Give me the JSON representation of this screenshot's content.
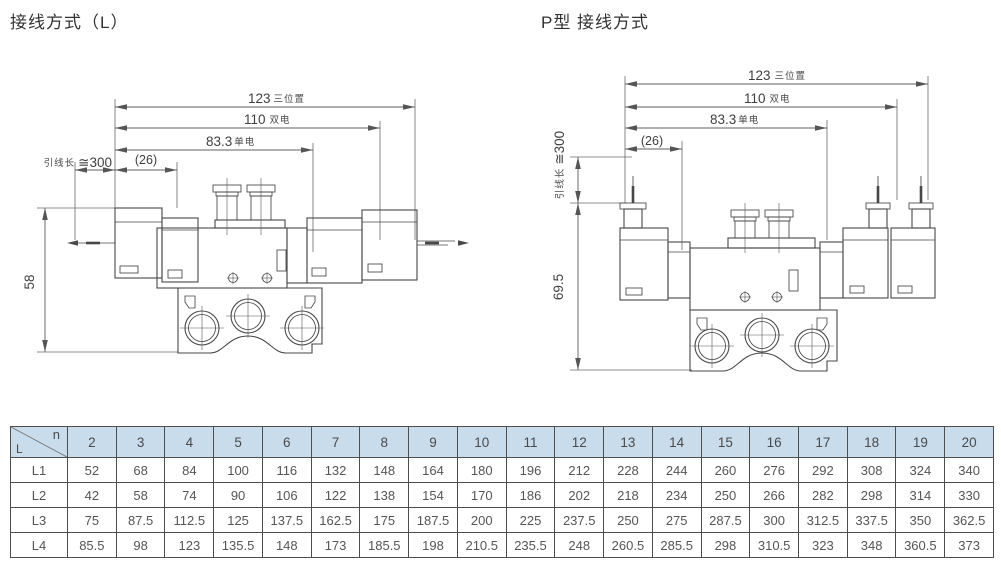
{
  "titles": {
    "left": "接线方式（L）",
    "right": "P型 接线方式"
  },
  "left_drawing": {
    "dim_123": "123",
    "dim_123_suffix": "三位置",
    "dim_110": "110",
    "dim_110_suffix": "双电",
    "dim_83": "83.3",
    "dim_83_suffix": "单电",
    "lead_label": "引线长",
    "lead_value": "≅300",
    "dim_26": "(26)",
    "dim_height": "58"
  },
  "right_drawing": {
    "dim_123": "123",
    "dim_123_suffix": "三位置",
    "dim_110": "110",
    "dim_110_suffix": "双电",
    "dim_83": "83.3",
    "dim_83_suffix": "单电",
    "lead_label": "引线长",
    "lead_value": "≅300",
    "dim_26": "(26)",
    "dim_height": "69.5"
  },
  "table": {
    "corner_top": "n",
    "corner_bottom": "L",
    "columns": [
      "2",
      "3",
      "4",
      "5",
      "6",
      "7",
      "8",
      "9",
      "10",
      "11",
      "12",
      "13",
      "14",
      "15",
      "16",
      "17",
      "18",
      "19",
      "20"
    ],
    "rows": [
      {
        "label": "L1",
        "values": [
          "52",
          "68",
          "84",
          "100",
          "116",
          "132",
          "148",
          "164",
          "180",
          "196",
          "212",
          "228",
          "244",
          "260",
          "276",
          "292",
          "308",
          "324",
          "340"
        ]
      },
      {
        "label": "L2",
        "values": [
          "42",
          "58",
          "74",
          "90",
          "106",
          "122",
          "138",
          "154",
          "170",
          "186",
          "202",
          "218",
          "234",
          "250",
          "266",
          "282",
          "298",
          "314",
          "330"
        ]
      },
      {
        "label": "L3",
        "values": [
          "75",
          "87.5",
          "112.5",
          "125",
          "137.5",
          "162.5",
          "175",
          "187.5",
          "200",
          "225",
          "237.5",
          "250",
          "275",
          "287.5",
          "300",
          "312.5",
          "337.5",
          "350",
          "362.5"
        ]
      },
      {
        "label": "L4",
        "values": [
          "85.5",
          "98",
          "123",
          "135.5",
          "148",
          "173",
          "185.5",
          "198",
          "210.5",
          "235.5",
          "248",
          "260.5",
          "285.5",
          "298",
          "310.5",
          "323",
          "348",
          "360.5",
          "373"
        ]
      }
    ]
  },
  "colors": {
    "header_bg": "#c9dcec",
    "border": "#4e4e4e",
    "line_art": "#474747",
    "dimension": "#5f5f5f",
    "text": "#4f4f4f",
    "title": "#333333"
  }
}
